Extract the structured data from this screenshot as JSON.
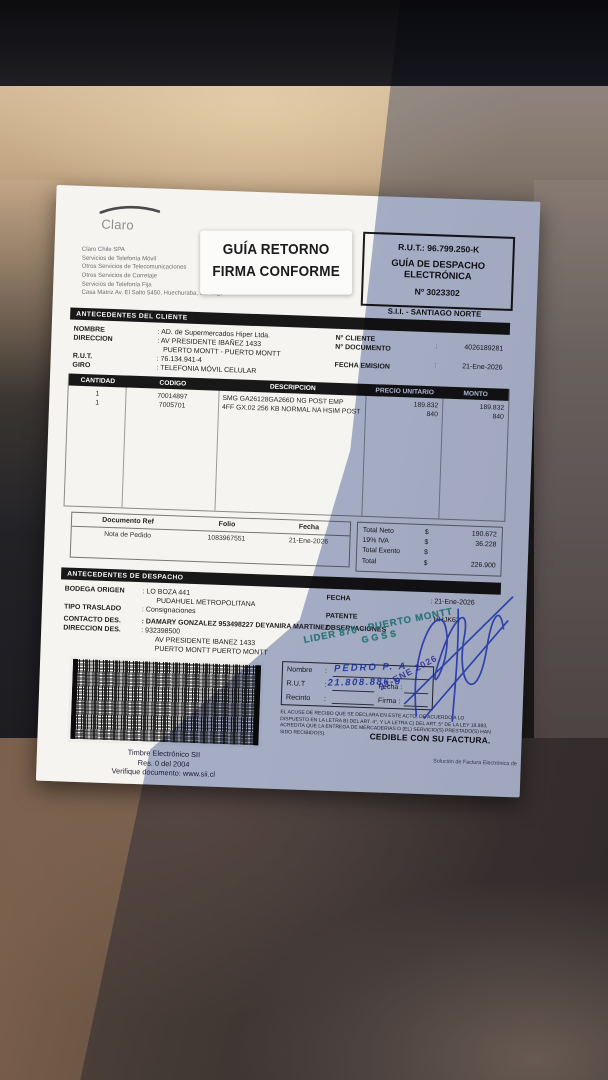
{
  "colors": {
    "paper_lit": "#f5f4f0",
    "shadow_tint": "#6072a8",
    "stamp_green": "#2f9e86",
    "pen_blue": "#2b49c0",
    "seat_beige": "#c2a683",
    "seat_brown": "#63503f",
    "dash_dark": "#141417"
  },
  "header": {
    "logo": "Claro",
    "company_lines": [
      "Claro Chile SPA",
      "Servicios de Telefonía Móvil",
      "Otros Servicios de Telecomunicaciones",
      "Otros Servicios de Corretaje",
      "Servicios de Telefonía Fija",
      "Casa Matriz Av. El Salto 5450, Huechuraba, Santiago"
    ],
    "return_stamp_line1": "GUÍA RETORNO",
    "return_stamp_line2": "FIRMA CONFORME",
    "rut_box": {
      "rut": "R.U.T.: 96.799.250-K",
      "doc_type_line1": "GUÍA DE DESPACHO",
      "doc_type_line2": "ELECTRÓNICA",
      "number": "Nº 3023302"
    },
    "sii_office": "S.I.I. - SANTIAGO NORTE"
  },
  "client": {
    "title": "ANTECEDENTES DEL CLIENTE",
    "nombre_label": "NOMBRE",
    "nombre_value": ":  AD. de Supermercados Hiper Ltda.",
    "direccion_label": "DIRECCION",
    "direccion_value": ":  AV PRESIDENTE IBAÑEZ 1433",
    "direccion_value2": "PUERTO MONTT -  PUERTO MONTT",
    "rut_label": "R.U.T.",
    "rut_value": ":  76.134.941-4",
    "giro_label": "GIRO",
    "giro_value": ":  TELEFONIA MÓVIL CELULAR",
    "ncliente_label": "N° CLIENTE",
    "ndocumento_label": "N° DOCUMENTO",
    "ndocumento_colon": ":",
    "ndocumento_value": "4026189281",
    "fecha_emision_label": "FECHA EMISION",
    "fecha_emision_colon": ":",
    "fecha_emision_value": "21-Ene-2026"
  },
  "items": {
    "headers": [
      "CANTIDAD",
      "CODIGO",
      "DESCRIPCION",
      "PRECIO UNITARIO",
      "MONTO"
    ],
    "rows": [
      {
        "cantidad": "1",
        "codigo": "70014897",
        "descripcion": "SMG GA26128GA266D NG POST EMP",
        "precio_unitario": "189.832",
        "monto": "189.832"
      },
      {
        "cantidad": "1",
        "codigo": "7005701",
        "descripcion": "4FF GX.02 256 KB NORMAL NA HSIM POST",
        "precio_unitario": "840",
        "monto": "840"
      }
    ]
  },
  "reference": {
    "headers": [
      "Documento Ref",
      "Folio",
      "Fecha"
    ],
    "values": [
      "Nota de Pedido",
      "1083967551",
      "21-Ene-2026"
    ]
  },
  "totals": {
    "rows": [
      {
        "label": "Total Neto",
        "sign": "$",
        "value": "190.672"
      },
      {
        "label": "19% IVA",
        "sign": "$",
        "value": "36.228"
      },
      {
        "label": "Total Exento",
        "sign": "$",
        "value": ""
      },
      {
        "label": "Total",
        "sign": "$",
        "value": "226.900"
      }
    ]
  },
  "dispatch": {
    "title": "ANTECEDENTES DE DESPACHO",
    "bodega_label": "BODEGA ORIGEN",
    "bodega_value": ":   LO BOZA 441",
    "bodega_value2": "PUDAHUEL  METROPOLITANA",
    "tipo_label": "TIPO TRASLADO",
    "tipo_value": ":   Consignaciones",
    "fecha_label": "FECHA",
    "fecha_value": ":   21-Ene-2026",
    "patente_label": "PATENTE",
    "patente_value": ":   HHJK63",
    "contacto_label": "CONTACTO DES.",
    "contacto_value": ":  DAMARY GONZALEZ 953498227 DEYANIRA MARTINEZ",
    "direccion_label": "DIRECCION DES.",
    "direccion_value": ":   932398500",
    "direccion_value2": "AV PRESIDENTE IBANEZ 1433",
    "direccion_value3": "PUERTO MONTT   PUERTO MONTT",
    "observaciones_label": "OBSERVACIONES"
  },
  "reception": {
    "nombre_label": "Nombre",
    "rut_label": "R.U.T",
    "recinto_label": "Recinto",
    "colon": ":",
    "fecha_label": "Fecha :",
    "firma_label": "Firma :",
    "handwritten_name": "PEDRO P. A",
    "handwritten_rut": "21.808.886-9",
    "date_stamp": "21 ENE 2026",
    "legal_text": "EL ACUSE DE RECIBO QUE SE DECLARA EN ESTE ACTO, DE ACUERDO A LO DISPUESTO EN LA LETRA B) DEL ART. 4°, Y LA LETRA C) DEL ART. 5° DE LA LEY 19.983, ACREDITA QUE LA ENTREGA DE MERCADERIAS O (EL) SERVICIO(S) PRESTADO(S) HAN SIDO RECIBIDO(S).",
    "cedible": "CEDIBLE CON SU FACTURA."
  },
  "lider_stamp": {
    "line1": "LIDER 870 - PUERTO MONTT",
    "line2": "GGSS"
  },
  "timbre": {
    "line1": "Timbre Electrónico SII",
    "line2": "Res. 0 del 2004",
    "line3": "Verifique documento: www.sii.cl"
  },
  "footer_note": "Solución de Factura Electrónica de"
}
